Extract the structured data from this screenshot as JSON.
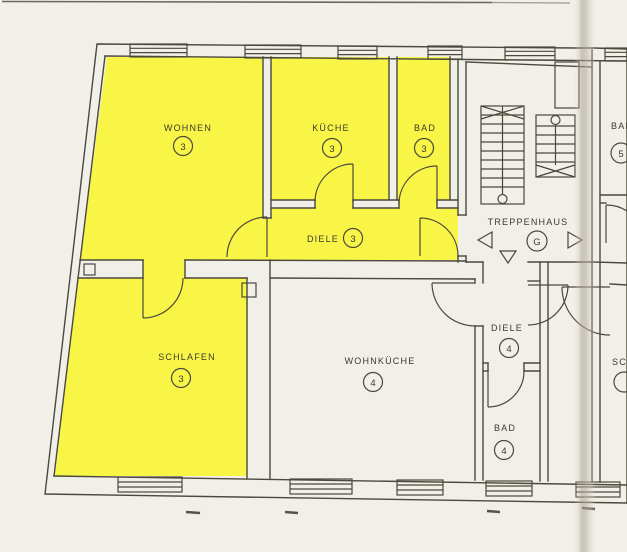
{
  "plan": {
    "rooms": [
      {
        "id": "wohnen",
        "label": "WOHNEN",
        "number": "3",
        "highlighted": true
      },
      {
        "id": "kueche",
        "label": "KÜCHE",
        "number": "3",
        "highlighted": true
      },
      {
        "id": "bad3",
        "label": "BAD",
        "number": "3",
        "highlighted": true
      },
      {
        "id": "diele3",
        "label": "DIELE",
        "number": "3",
        "highlighted": true
      },
      {
        "id": "schlafen",
        "label": "SCHLAFEN",
        "number": "3",
        "highlighted": true
      },
      {
        "id": "wohnkueche",
        "label": "WOHNKÜCHE",
        "number": "4",
        "highlighted": false
      },
      {
        "id": "treppenhaus",
        "label": "TREPPENHAUS",
        "number": "G",
        "highlighted": false
      },
      {
        "id": "diele4",
        "label": "DIELE",
        "number": "4",
        "highlighted": false
      },
      {
        "id": "bad4",
        "label": "BAD",
        "number": "4",
        "highlighted": false
      },
      {
        "id": "bad5",
        "label": "BAD",
        "number": "5",
        "highlighted": false
      },
      {
        "id": "schlafen5",
        "label": "SC",
        "number": "",
        "highlighted": false
      }
    ],
    "stairwell_arrows": [
      "left",
      "down",
      "right"
    ],
    "colors": {
      "highlight": "#f8f546",
      "line": "#4b483d",
      "paper": "#f0efe8",
      "wall_fill": "#ebe7da"
    }
  }
}
